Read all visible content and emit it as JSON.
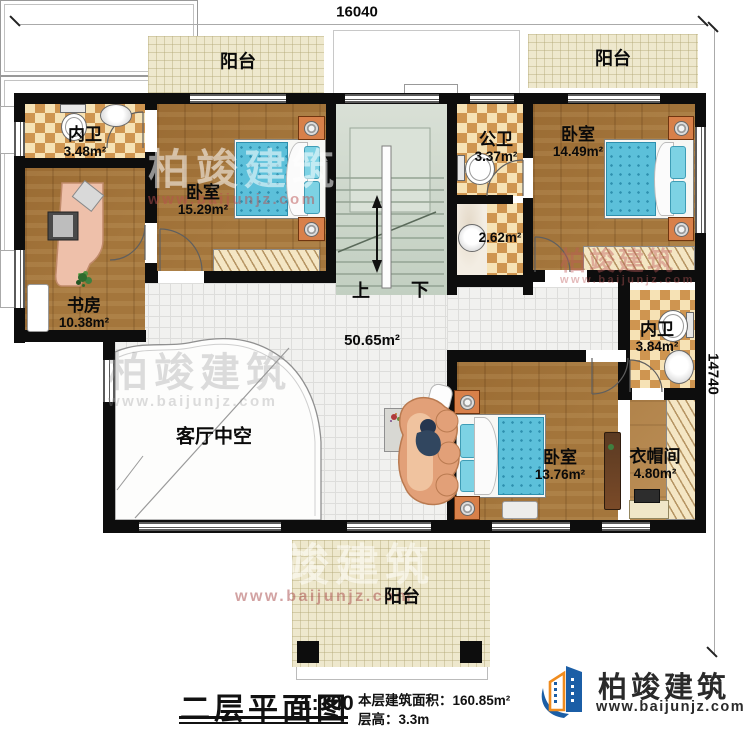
{
  "dimensions": {
    "width_top": "16040",
    "height_right": "14740"
  },
  "rooms": {
    "balcony_top_left": {
      "name": "阳台"
    },
    "balcony_top_right": {
      "name": "阳台"
    },
    "balcony_bottom": {
      "name": "阳台"
    },
    "bath_top_left": {
      "name": "内卫",
      "area": "3.48m²"
    },
    "bedroom_left": {
      "name": "卧室",
      "area": "15.29m²"
    },
    "public_bath": {
      "name": "公卫",
      "area": "3.37m²"
    },
    "wash_room": {
      "area": "2.62m²"
    },
    "bedroom_right": {
      "name": "卧室",
      "area": "14.49m²"
    },
    "study": {
      "name": "书房",
      "area": "10.38m²"
    },
    "bath_right": {
      "name": "内卫",
      "area": "3.84m²"
    },
    "hall": {
      "area": "50.65m²"
    },
    "living_void": {
      "name": "客厅中空"
    },
    "bedroom_bottom": {
      "name": "卧室",
      "area": "13.76m²"
    },
    "cloakroom": {
      "name": "衣帽间",
      "area": "4.80m²"
    },
    "stairs": {
      "up": "上",
      "down": "下"
    }
  },
  "title_block": {
    "title": "二层平面图",
    "scale": "1:100",
    "floor_area_label": "本层建筑面积：160.85m²",
    "floor_height_label": "层高：3.3m"
  },
  "logo": {
    "company": "柏竣建筑",
    "website": "www.baijunjz.com"
  },
  "watermark": {
    "company": "柏竣建筑",
    "website": "www.baijunjz.com"
  },
  "colors": {
    "wall": "#0d0d0d",
    "wood_floor": "#a4763c",
    "tile_floor": "#f1f1ef",
    "checker_dark": "#cf9550",
    "checker_light": "#f6e2b5",
    "balcony_floor": "#eee8cd",
    "stair_floor": "#ccd6cb",
    "bed_blue": "#5cc0da",
    "furniture_salmon": "#e2a078",
    "logo_blue": "#1b5ea6",
    "logo_orange": "#f08c1e"
  }
}
